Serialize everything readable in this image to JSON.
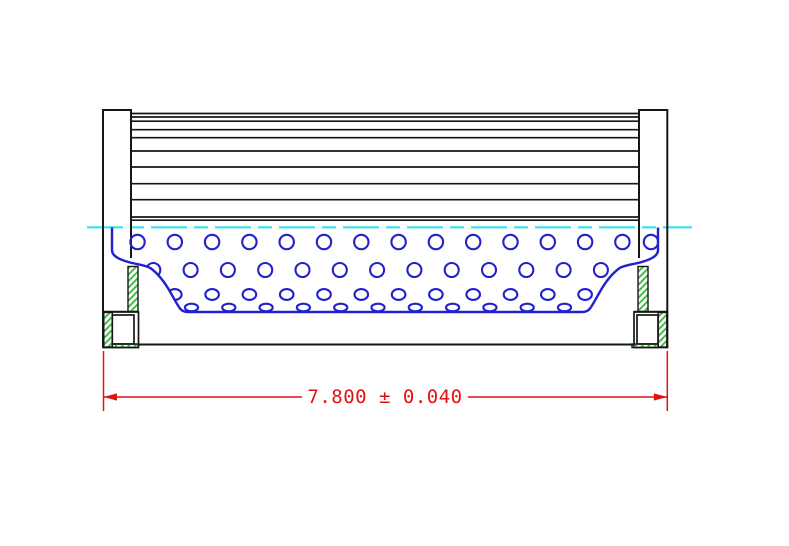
{
  "drawing": {
    "dimension": {
      "display": "7.800 ± 0.040",
      "value": "7.800",
      "symbol": "±",
      "tolerance": "0.040"
    },
    "colors": {
      "background": "#ffffff",
      "outline": "#161616",
      "core_blue": "#2121cd",
      "centerline_cyan": "#35e2ef",
      "hatch_green": "#3fbc3f",
      "dimension_red": "#e11212"
    },
    "geometry": {
      "canvas": {
        "width": 789,
        "height": 546
      },
      "pleats": {
        "x1": 131,
        "x2": 639,
        "lines": [
          113.5,
          117,
          121.2,
          129.7,
          137.7,
          151,
          167,
          183.7,
          199.7,
          217,
          220.2
        ],
        "line_width": 1.7
      },
      "caps": {
        "paths": [
          "M103,348 L103,110 L131,110 L131,258",
          "M667.3,348 L667.3,110 L639,110 L639,258"
        ],
        "stroke_width": 2
      },
      "step_top_lines": [
        [
          103,
          138.5,
          311.5
        ],
        [
          634,
          667.3,
          311.5
        ]
      ],
      "bottom_line": {
        "x1": 138.5,
        "x2": 634,
        "y": 344.5,
        "width": 2
      },
      "outline_rects": [
        [
          103.3,
          312,
          35.2,
          35.5
        ],
        [
          634,
          312,
          33.3,
          35.5
        ],
        [
          112.3,
          315,
          21.7,
          29
        ],
        [
          637,
          315,
          21,
          29
        ]
      ],
      "hatch_rects": [
        [
          128,
          266.5,
          10,
          45
        ],
        [
          638,
          266.5,
          10,
          45
        ],
        [
          103.8,
          312.5,
          8.5,
          34.5
        ],
        [
          658.2,
          312.5,
          8.6,
          34.5
        ],
        [
          112.3,
          344,
          26,
          3.5
        ],
        [
          632,
          344,
          26,
          3.5
        ]
      ],
      "hatch_outline_width": 1.4,
      "centerline": {
        "y": 227.3,
        "x1": 87,
        "x2": 692,
        "dash": "36 7 14 7",
        "width": 2.2
      },
      "core": {
        "edge_path": "M112,227.5 L112,250 C112,256 119,259.5 130,262.5 C139,264.8 146,265.2 151,268.5 C159,274.5 165.5,283.5 170.5,292.5 C174.5,299.5 177,304.5 180,308.5 C182,311.2 184.5,312 188,312 L582,312 C585.5,312 588,311.2 590,308.5 C593,304.5 595.5,299.5 599.5,292.5 C604.5,283.5 611,274.5 619,268.5 C624,265.2 631,264.8 640,262.5 C651,259.5 658,256 658,250 L658,227.5",
        "stroke_width": 2.4,
        "hole_stroke_width": 2.1,
        "rows": [
          {
            "cy": 242,
            "rx": 7.2,
            "ry": 7.2,
            "start": 137.5,
            "pitch": 37.3,
            "count": 14,
            "extra": [
              651
            ]
          },
          {
            "cy": 270,
            "rx": 7.0,
            "ry": 7.0,
            "start": 153.3,
            "pitch": 37.3,
            "count": 13,
            "extra": []
          },
          {
            "cy": 294.5,
            "rx": 6.8,
            "ry": 5.4,
            "start": 174.8,
            "pitch": 37.3,
            "count": 12,
            "extra": []
          },
          {
            "cy": 307.5,
            "rx": 6.6,
            "ry": 3.8,
            "start": 191.5,
            "pitch": 37.3,
            "count": 11,
            "extra": []
          }
        ]
      },
      "dim": {
        "ext_lines": [
          [
            103.5,
            351,
            411
          ],
          [
            667.3,
            351,
            411
          ]
        ],
        "line_y": 397,
        "segments": [
          [
            103.5,
            302
          ],
          [
            468,
            667.3
          ]
        ],
        "arrows": [
          {
            "tip": 103.5,
            "dir": 1
          },
          {
            "tip": 667.3,
            "dir": -1
          }
        ],
        "arrow_len": 13.5,
        "arrow_half_w": 3.6,
        "text_x": 385,
        "text_y": 397,
        "font_size": 19,
        "stroke_width": 1.5
      }
    }
  }
}
